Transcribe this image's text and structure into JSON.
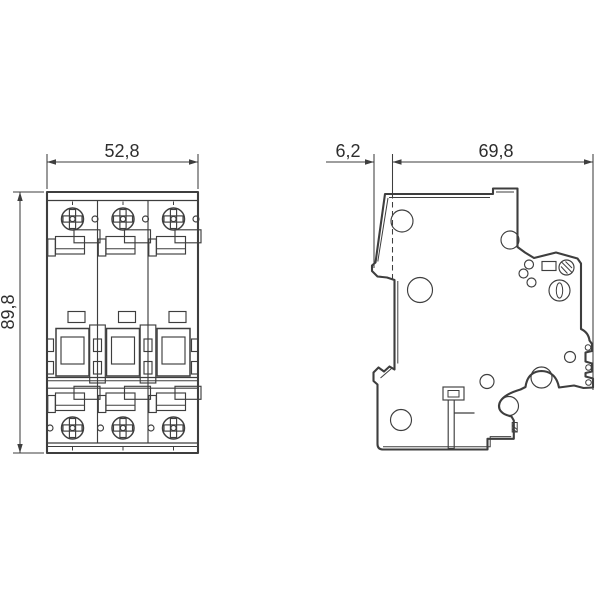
{
  "drawing": {
    "kind": "technical-dimension-drawing",
    "background": "#ffffff",
    "line_color": "#3e3e3e",
    "text_color": "#2e2e2e",
    "views": {
      "front": {
        "pole_count": 3,
        "width_label": "52,8",
        "height_label": "89,8"
      },
      "side": {
        "handle_depth_label": "6,2",
        "body_depth_label": "69,8"
      }
    }
  }
}
